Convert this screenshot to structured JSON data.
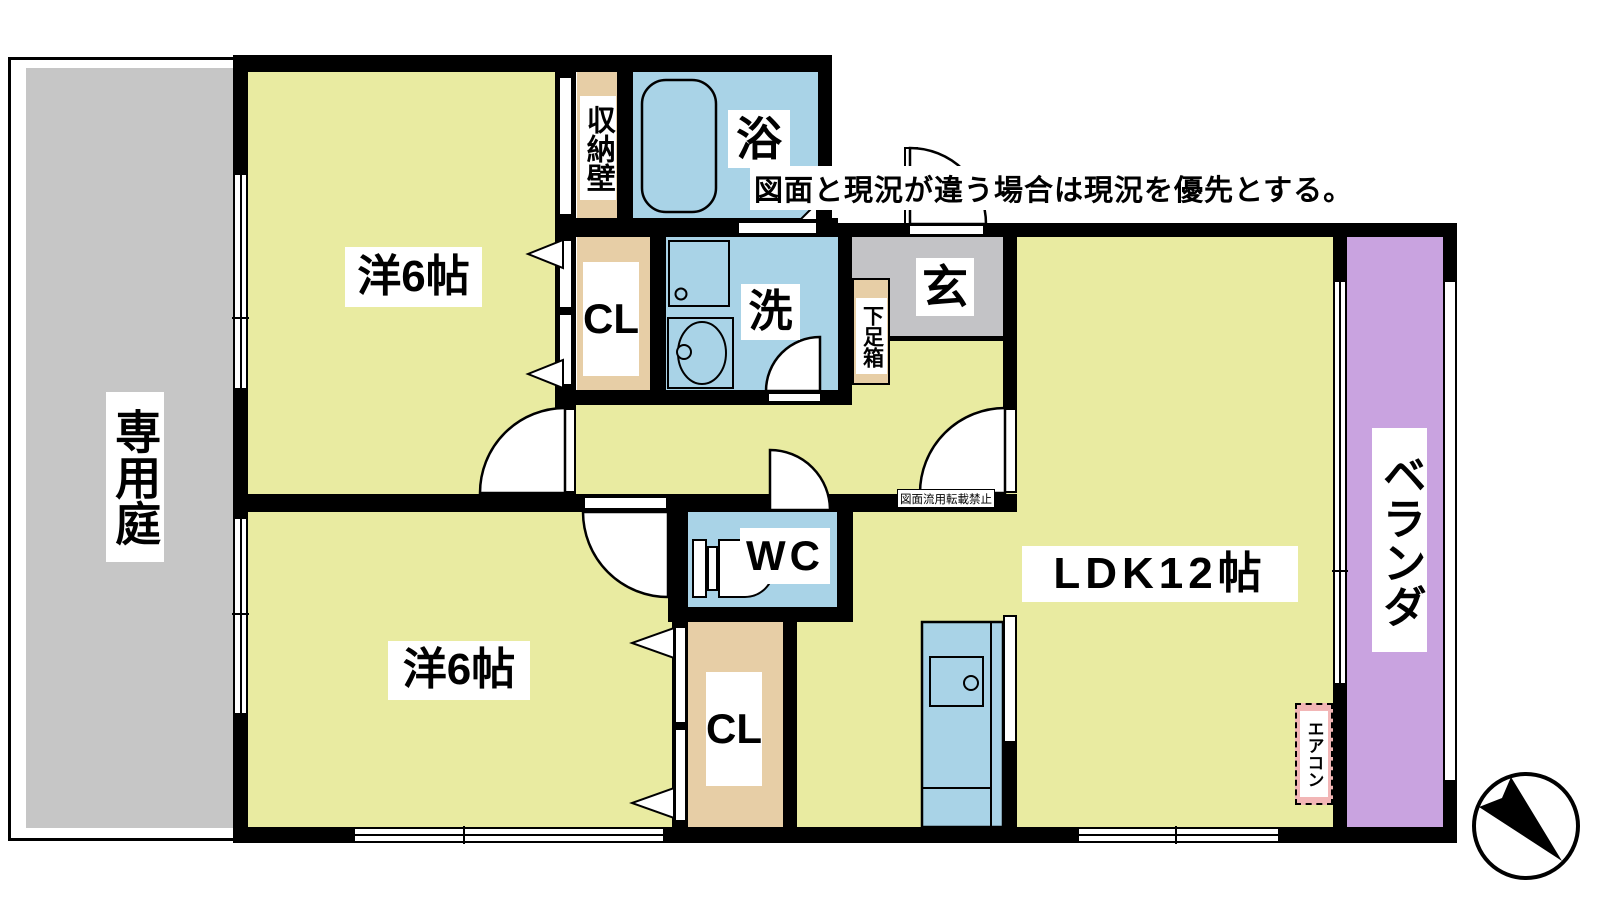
{
  "disclaimer": "図面と現況が違う場合は現況を優先とする。",
  "watermark": "図面流用転載禁止",
  "rooms": {
    "bedroom_top": {
      "label": "洋6帖"
    },
    "bedroom_bottom": {
      "label": "洋6帖"
    },
    "ldk": {
      "label": "LDK12帖"
    },
    "bath": {
      "label": "浴"
    },
    "washroom": {
      "label": "洗"
    },
    "toilet": {
      "label": "WC"
    },
    "entrance": {
      "label": "玄"
    },
    "private_garden": {
      "label": "専用庭"
    },
    "veranda": {
      "label": "ベランダ"
    }
  },
  "fixtures": {
    "storage_wall": {
      "label": "収納壁"
    },
    "closet_top": {
      "label": "CL"
    },
    "closet_bottom": {
      "label": "CL"
    },
    "shoe_box": {
      "label": "下足箱"
    },
    "air_conditioner": {
      "label": "エアコン"
    }
  },
  "colors": {
    "room_floor": "#e9eba1",
    "water_area": "#a9d3e7",
    "closet": "#e7cea6",
    "garden": "#c6c6c6",
    "entrance_floor": "#c3c3c6",
    "veranda": "#c9a3e0",
    "aircon_bg": "#f2b6b6",
    "wall": "#000000"
  }
}
